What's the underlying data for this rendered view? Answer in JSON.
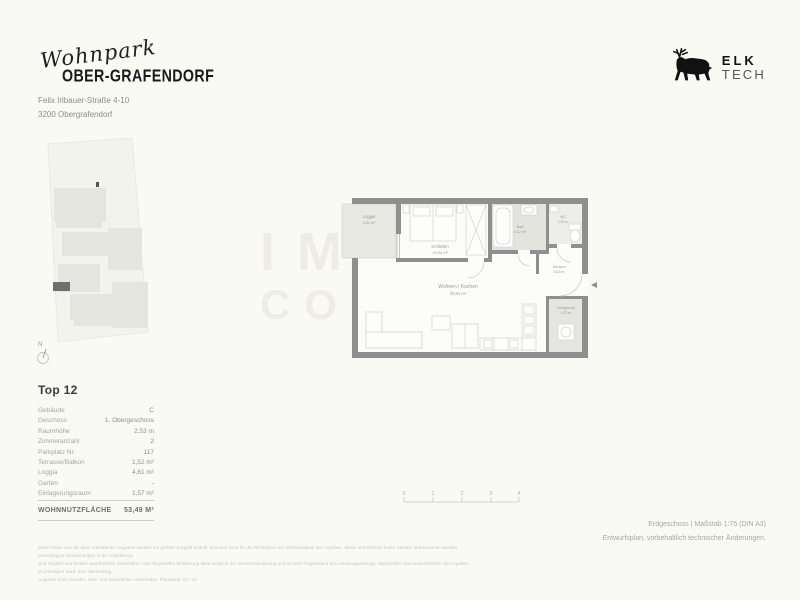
{
  "header": {
    "project_script": "Wohnpark",
    "project_name": "OBER-GRAFENDORF",
    "address_line1": "Felix Irlbauer-Straße 4-10",
    "address_line2": "3200 Obergrafendorf"
  },
  "brand": {
    "name_bold": "ELK",
    "name_light": "TECH"
  },
  "site_plan": {
    "north_label": "N"
  },
  "watermark": {
    "line1": "IMMO",
    "line2": "CONNECT"
  },
  "floor_plan": {
    "rooms": [
      {
        "name": "Loggia",
        "area": "4,61 m²"
      },
      {
        "name": "Schlafen",
        "area": "13,94 m²"
      },
      {
        "name": "Bad",
        "area": "4,12 m²"
      },
      {
        "name": "WC",
        "area": "1,20 m²"
      },
      {
        "name": "Wohnen | Kochen",
        "area": "30,61 m²"
      },
      {
        "name": "Vorraum",
        "area": "3,62 m²"
      },
      {
        "name": "Einlagerung",
        "area": "1,57 m²"
      }
    ]
  },
  "unit": {
    "title": "Top 12",
    "rows": [
      {
        "label": "Gebäude",
        "value": "C"
      },
      {
        "label": "Geschoss",
        "value": "1. Obergeschoss"
      },
      {
        "label": "Raumhöhe",
        "value": "2,53 m"
      },
      {
        "label": "Zimmeranzahl",
        "value": "2"
      },
      {
        "label": "Parkplatz Nr.",
        "value": "117"
      },
      {
        "label": "Terrasse/Balkon",
        "value": "1,52 m²"
      },
      {
        "label": "Loggia",
        "value": "4,61 m²"
      },
      {
        "label": "Garten",
        "value": "-"
      },
      {
        "label": "Einlagerungsraum",
        "value": "1,57 m²"
      }
    ],
    "total_label": "WOHNNUTZFLÄCHE",
    "total_value": "53,49 M²"
  },
  "scale_bar": {
    "ticks": [
      "0",
      "1",
      "2",
      "3",
      "4"
    ]
  },
  "footer": {
    "plan_info": "Erdgeschoss | Maßstab 1:75 (DIN A3)",
    "note": "Entwurfsplan, vorbehaltlich technischer Änderungen.",
    "disclaimer1": "Diese Pläne und die darin enthaltenen Angaben wurden mit größter Sorgfalt erstellt, dennoch kann für die Richtigkeit und Vollständigkeit der Angaben, Maße und Flächen keine Gewähr übernommen werden. Geringfügige Abweichungen in der Ausführung",
    "disclaimer2": "sind möglich und bleiben ausdrücklich vorbehalten. Die dargestellte Möblierung dient lediglich der Veranschaulichung und ist nicht Gegenstand des Leistungsumfangs. Maßgeblich sind ausschließlich die Angaben im jeweiligen Kauf- bzw. Mietvertrag.",
    "disclaimer3": "Angaben ohne Gewähr. Satz- und Druckfehler vorbehalten. Planstand: 01 / 23."
  }
}
